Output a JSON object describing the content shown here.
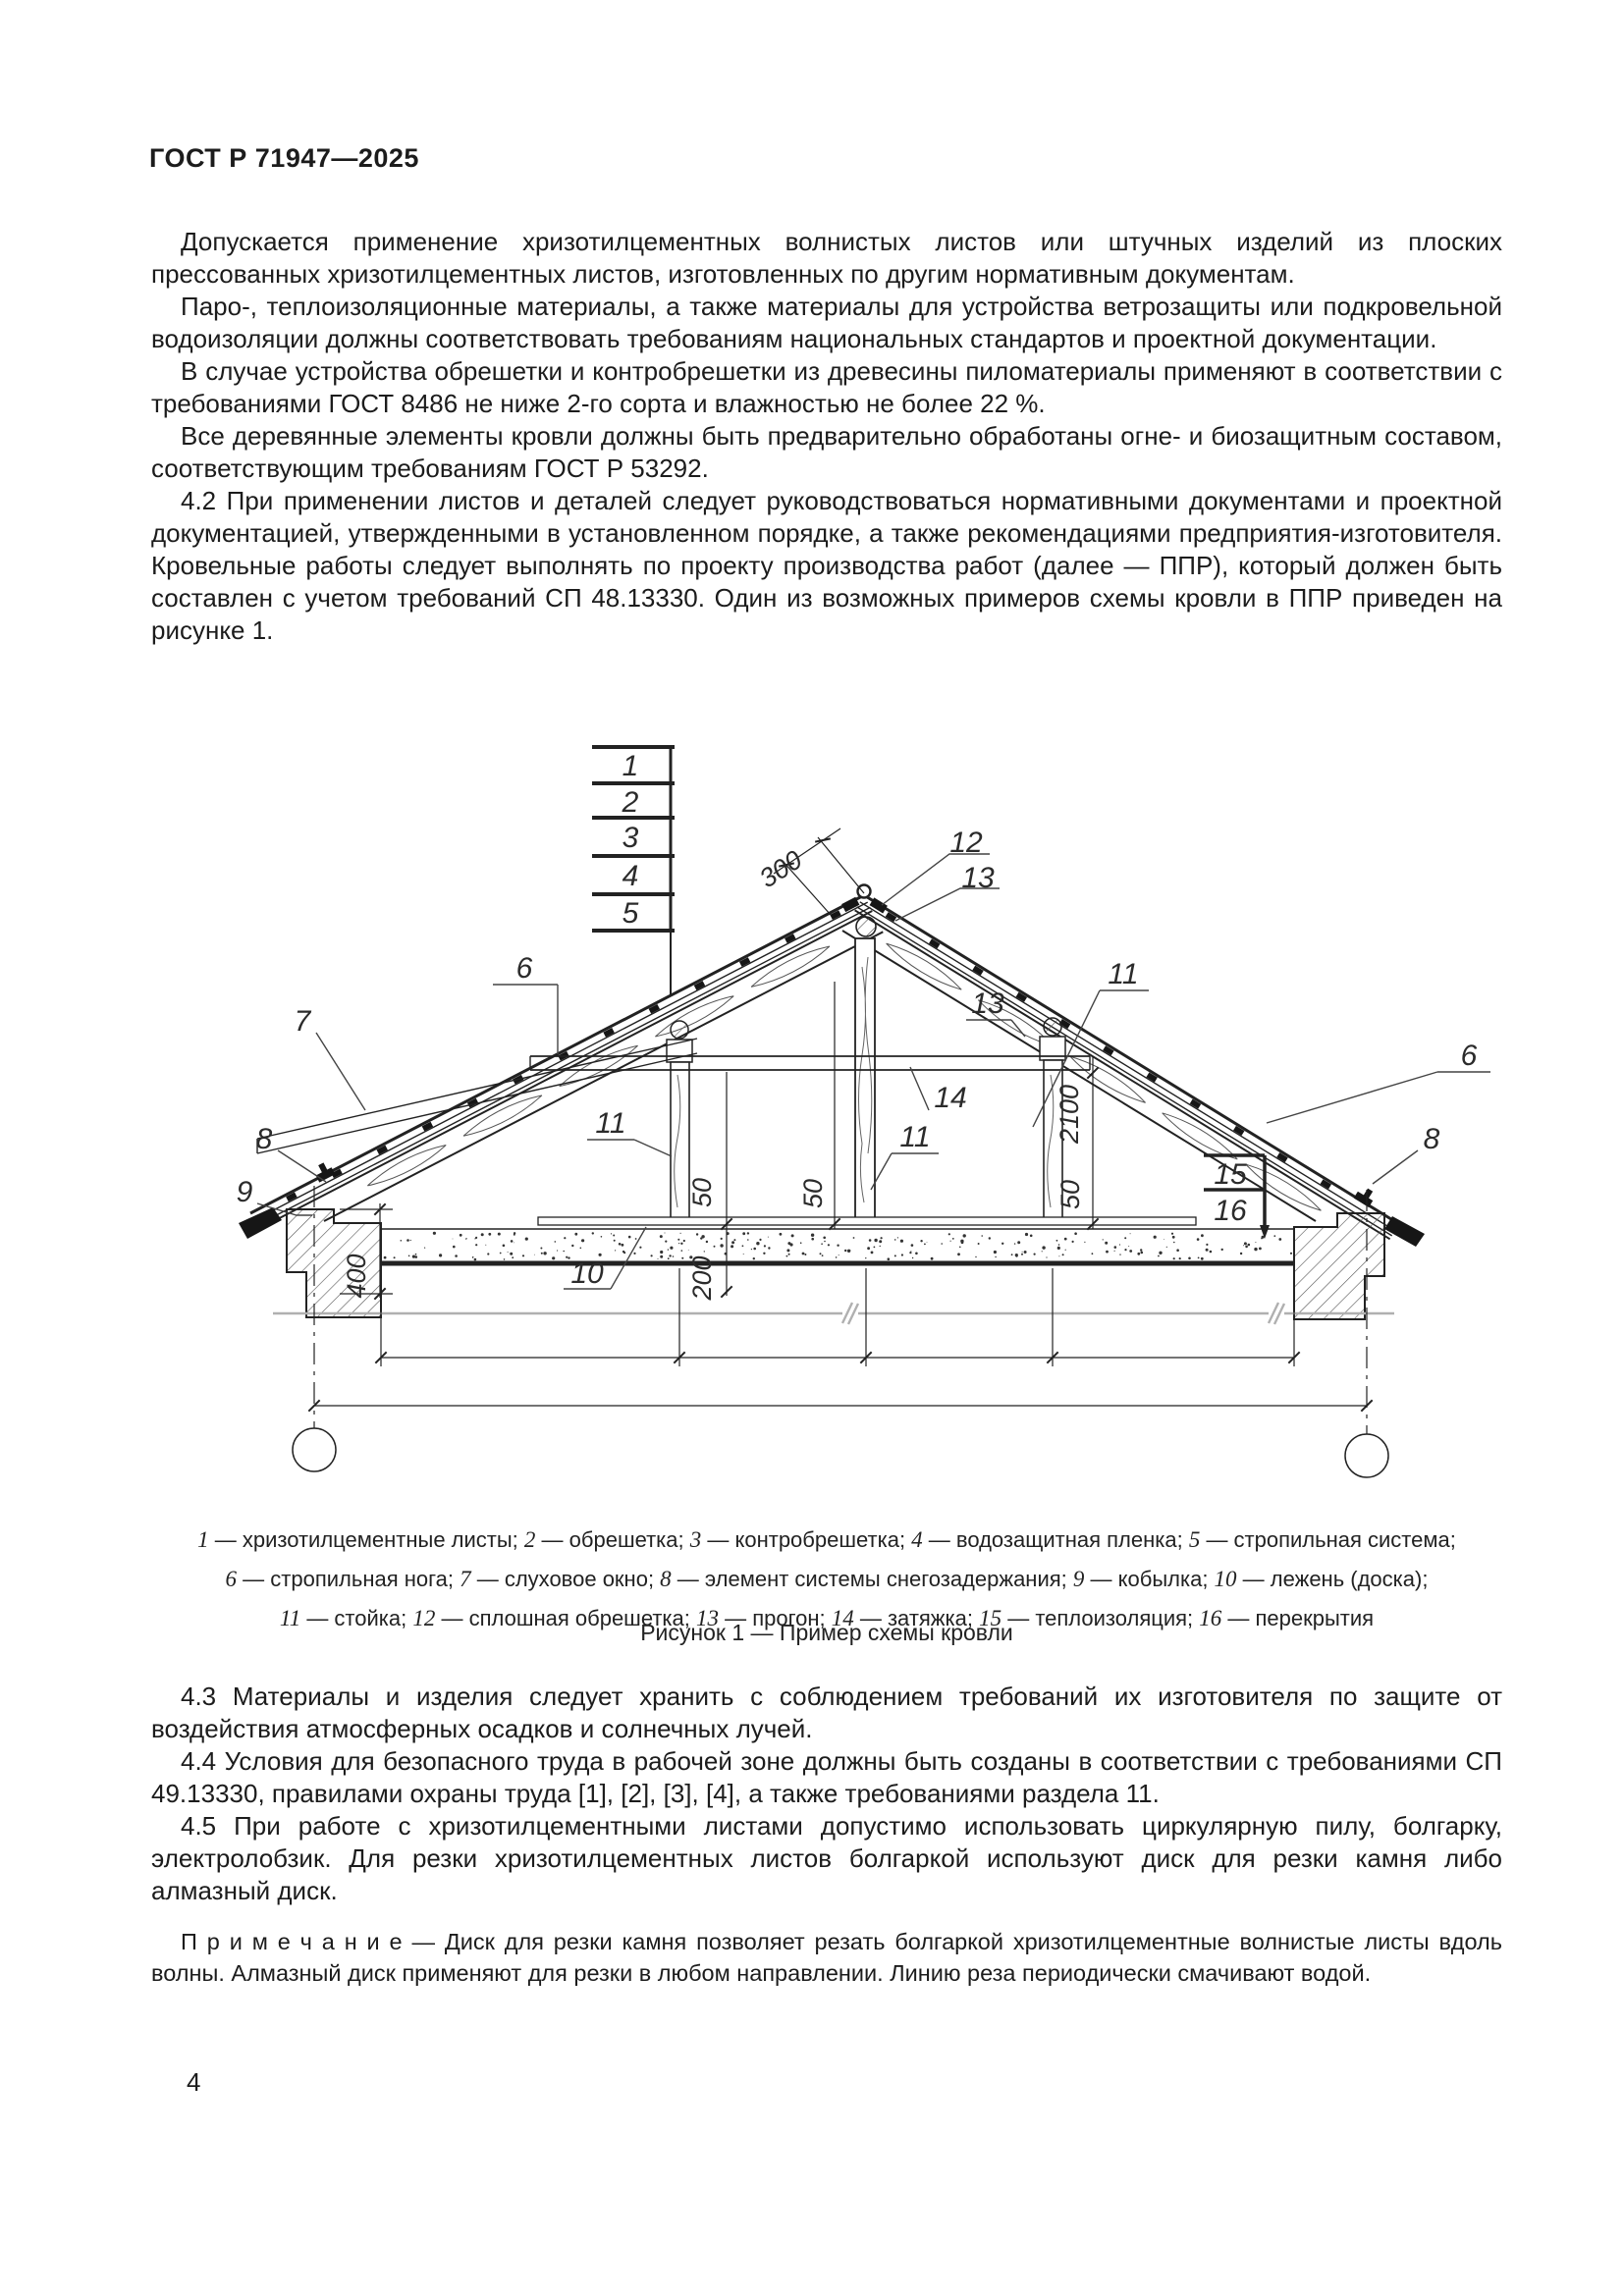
{
  "page": {
    "header": "ГОСТ Р 71947—2025",
    "page_number": "4"
  },
  "body": {
    "paragraphs": [
      "Допускается применение хризотилцементных волнистых листов или штучных изделий из плоских прессованных хризотилцементных листов, изготовленных по другим нормативным документам.",
      "Паро-, теплоизоляционные материалы, а также материалы для устройства ветрозащиты или подкровельной водоизоляции должны соответствовать требованиям национальных стандартов и проектной документации.",
      "В случае устройства обрешетки и контробрешетки из древесины пиломатериалы применяют в соответствии с требованиями ГОСТ 8486 не ниже 2-го сорта и влажностью не более 22 %.",
      "Все деревянные элементы кровли должны быть предварительно обработаны огне- и биозащитным составом, соответствующим требованиям ГОСТ Р 53292.",
      "4.2 При применении листов и деталей следует руководствоваться нормативными документами и проектной документацией, утвержденными в установленном порядке, а также рекомендациями предприятия-изготовителя. Кровельные работы следует выполнять по проекту производства работ (далее — ППР), который должен быть составлен с учетом требований СП 48.13330. Один из возможных примеров схемы кровли в ППР приведен на рисунке 1."
    ]
  },
  "after_figure": {
    "paragraphs": [
      "4.3 Материалы и изделия следует хранить с соблюдением требований их изготовителя по защите от воздействия атмосферных осадков и солнечных лучей.",
      "4.4 Условия для безопасного труда в рабочей зоне должны быть созданы в соответствии с требованиями СП 49.13330, правилами охраны труда [1], [2], [3], [4], а также требованиями раздела 11.",
      "4.5 При работе с хризотилцементными листами допустимо использовать циркулярную пилу, болгарку, электролобзик. Для резки хризотилцементных листов болгаркой используют диск для резки камня либо алмазный диск."
    ],
    "note": "П р и м е ч а н и е  — Диск для резки камня позволяет резать болгаркой хризотилцементные волнистые листы вдоль волны. Алмазный диск применяют для резки в любом направлении. Линию реза периодически смачивают водой."
  },
  "figure": {
    "caption_title": "Рисунок 1 — Пример схемы кровли",
    "legend_lines": [
      [
        {
          "n": "1",
          "t": "хризотилцементные листы"
        },
        {
          "n": "2",
          "t": "обрешетка"
        },
        {
          "n": "3",
          "t": "контробрешетка"
        },
        {
          "n": "4",
          "t": "водозащитная пленка"
        },
        {
          "n": "5",
          "t": "стропильная система"
        }
      ],
      [
        {
          "n": "6",
          "t": "стропильная нога"
        },
        {
          "n": "7",
          "t": "слуховое окно"
        },
        {
          "n": "8",
          "t": "элемент системы снегозадержания"
        },
        {
          "n": "9",
          "t": "кобылка"
        },
        {
          "n": "10",
          "t": "лежень (доска)"
        }
      ],
      [
        {
          "n": "11",
          "t": "стойка"
        },
        {
          "n": "12",
          "t": "сплошная обрешетка"
        },
        {
          "n": "13",
          "t": "прогон"
        },
        {
          "n": "14",
          "t": "затяжка"
        },
        {
          "n": "15",
          "t": "теплоизоляция"
        },
        {
          "n": "16",
          "t": "перекрытия"
        }
      ]
    ],
    "callouts": {
      "n1": "1",
      "n2": "2",
      "n3": "3",
      "n4": "4",
      "n5": "5",
      "c6l": "6",
      "c6r": "6",
      "c7": "7",
      "c8l": "8",
      "c8r": "8",
      "c9": "9",
      "c10": "10",
      "c11l": "11",
      "c11c": "11",
      "c11r": "11",
      "c12": "12",
      "c13t": "13",
      "c13m": "13",
      "c14": "14",
      "c15": "15",
      "c16": "16",
      "d300": "300",
      "d400": "400",
      "d200": "200",
      "d2100": "2100",
      "d50a": "50",
      "d50b": "50",
      "d50c": "50"
    }
  }
}
